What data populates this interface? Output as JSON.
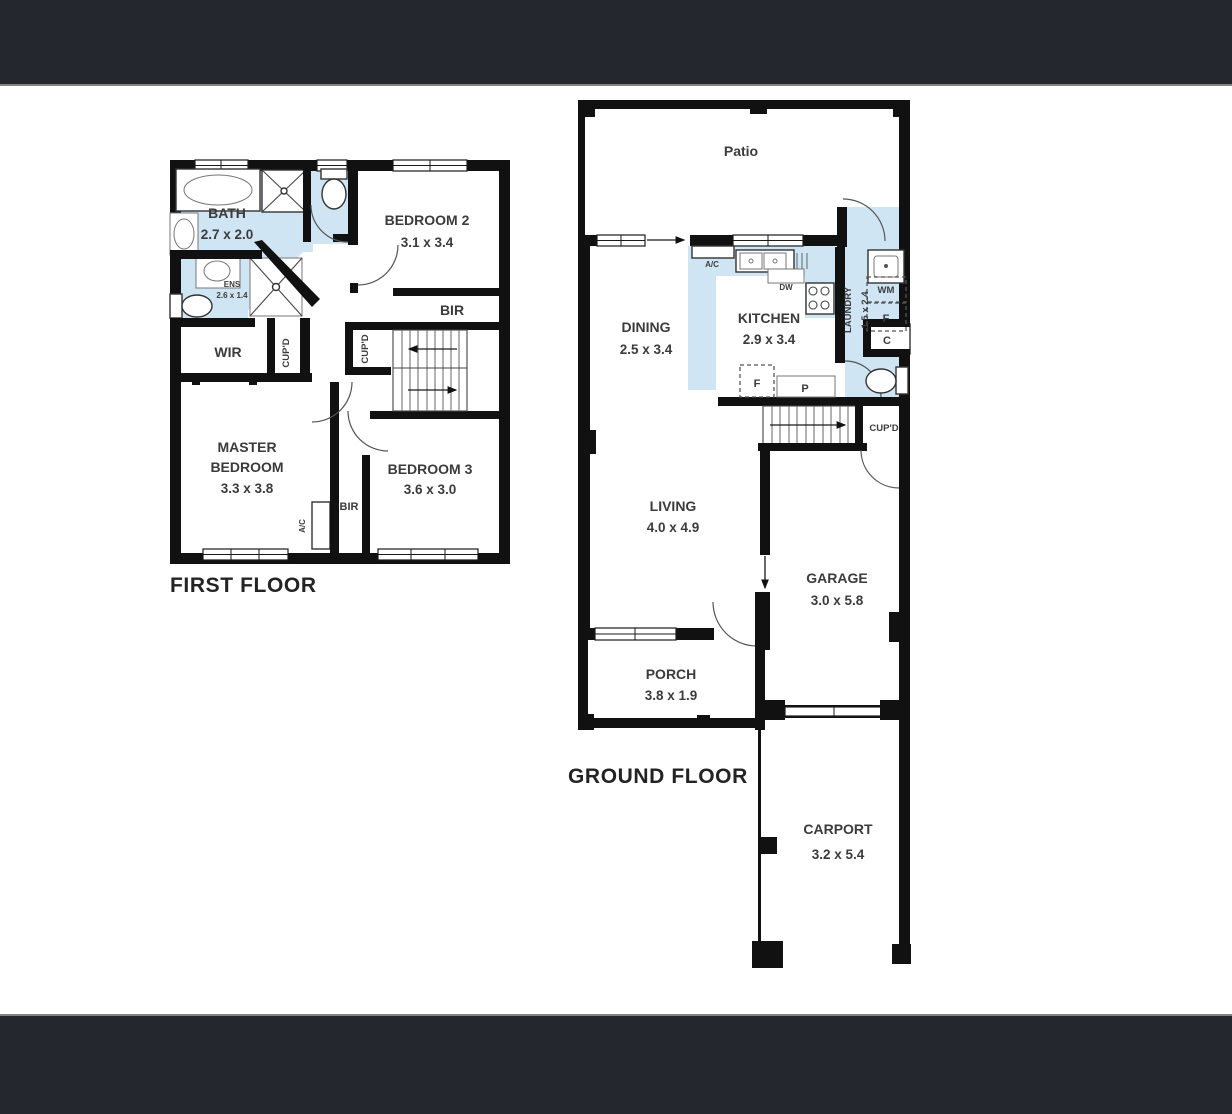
{
  "page": {
    "bg": "#ffffff",
    "bar_color": "#24272e",
    "divider_color": "#828282",
    "wall_color": "#111111",
    "wet_area_color": "#cfe5f4",
    "label_color": "#3b3b3b"
  },
  "first_floor": {
    "title": "FIRST FLOOR",
    "bath": {
      "name": "BATH",
      "dims": "2.7 x 2.0"
    },
    "ens": {
      "name": "ENS",
      "dims": "2.6 x 1.4"
    },
    "wir": {
      "name": "WIR"
    },
    "cupd_left": {
      "name": "CUP'D"
    },
    "cupd_mid": {
      "name": "CUP'D"
    },
    "bir_bed2": {
      "name": "BIR"
    },
    "bedroom2": {
      "name": "BEDROOM 2",
      "dims": "3.1 x 3.4"
    },
    "master": {
      "name_line1": "MASTER",
      "name_line2": "BEDROOM",
      "dims": "3.3 x 3.8"
    },
    "bir_master": {
      "name": "BIR"
    },
    "ac": {
      "name": "A/C"
    },
    "bedroom3": {
      "name": "BEDROOM 3",
      "dims": "3.6 x 3.0"
    }
  },
  "ground_floor": {
    "title": "GROUND FLOOR",
    "patio": {
      "name": "Patio"
    },
    "dining": {
      "name": "DINING",
      "dims": "2.5 x 3.4"
    },
    "kitchen": {
      "name": "KITCHEN",
      "dims": "2.9 x 3.4"
    },
    "ac": {
      "name": "A/C"
    },
    "dw": {
      "name": "DW"
    },
    "laundry": {
      "name": "LAUNDRY",
      "dims": "1.5 x 2.4"
    },
    "wm": {
      "name": "WM"
    },
    "fridge_laundry": {
      "name": "F"
    },
    "cupboard_c": {
      "name": "C"
    },
    "fridge_kitchen": {
      "name": "F"
    },
    "pantry": {
      "name": "P"
    },
    "cupd": {
      "name": "CUP'D"
    },
    "living": {
      "name": "LIVING",
      "dims": "4.0 x 4.9"
    },
    "garage": {
      "name": "GARAGE",
      "dims": "3.0 x 5.8"
    },
    "porch": {
      "name": "PORCH",
      "dims": "3.8 x 1.9"
    },
    "carport": {
      "name": "CARPORT",
      "dims": "3.2 x 5.4"
    }
  }
}
